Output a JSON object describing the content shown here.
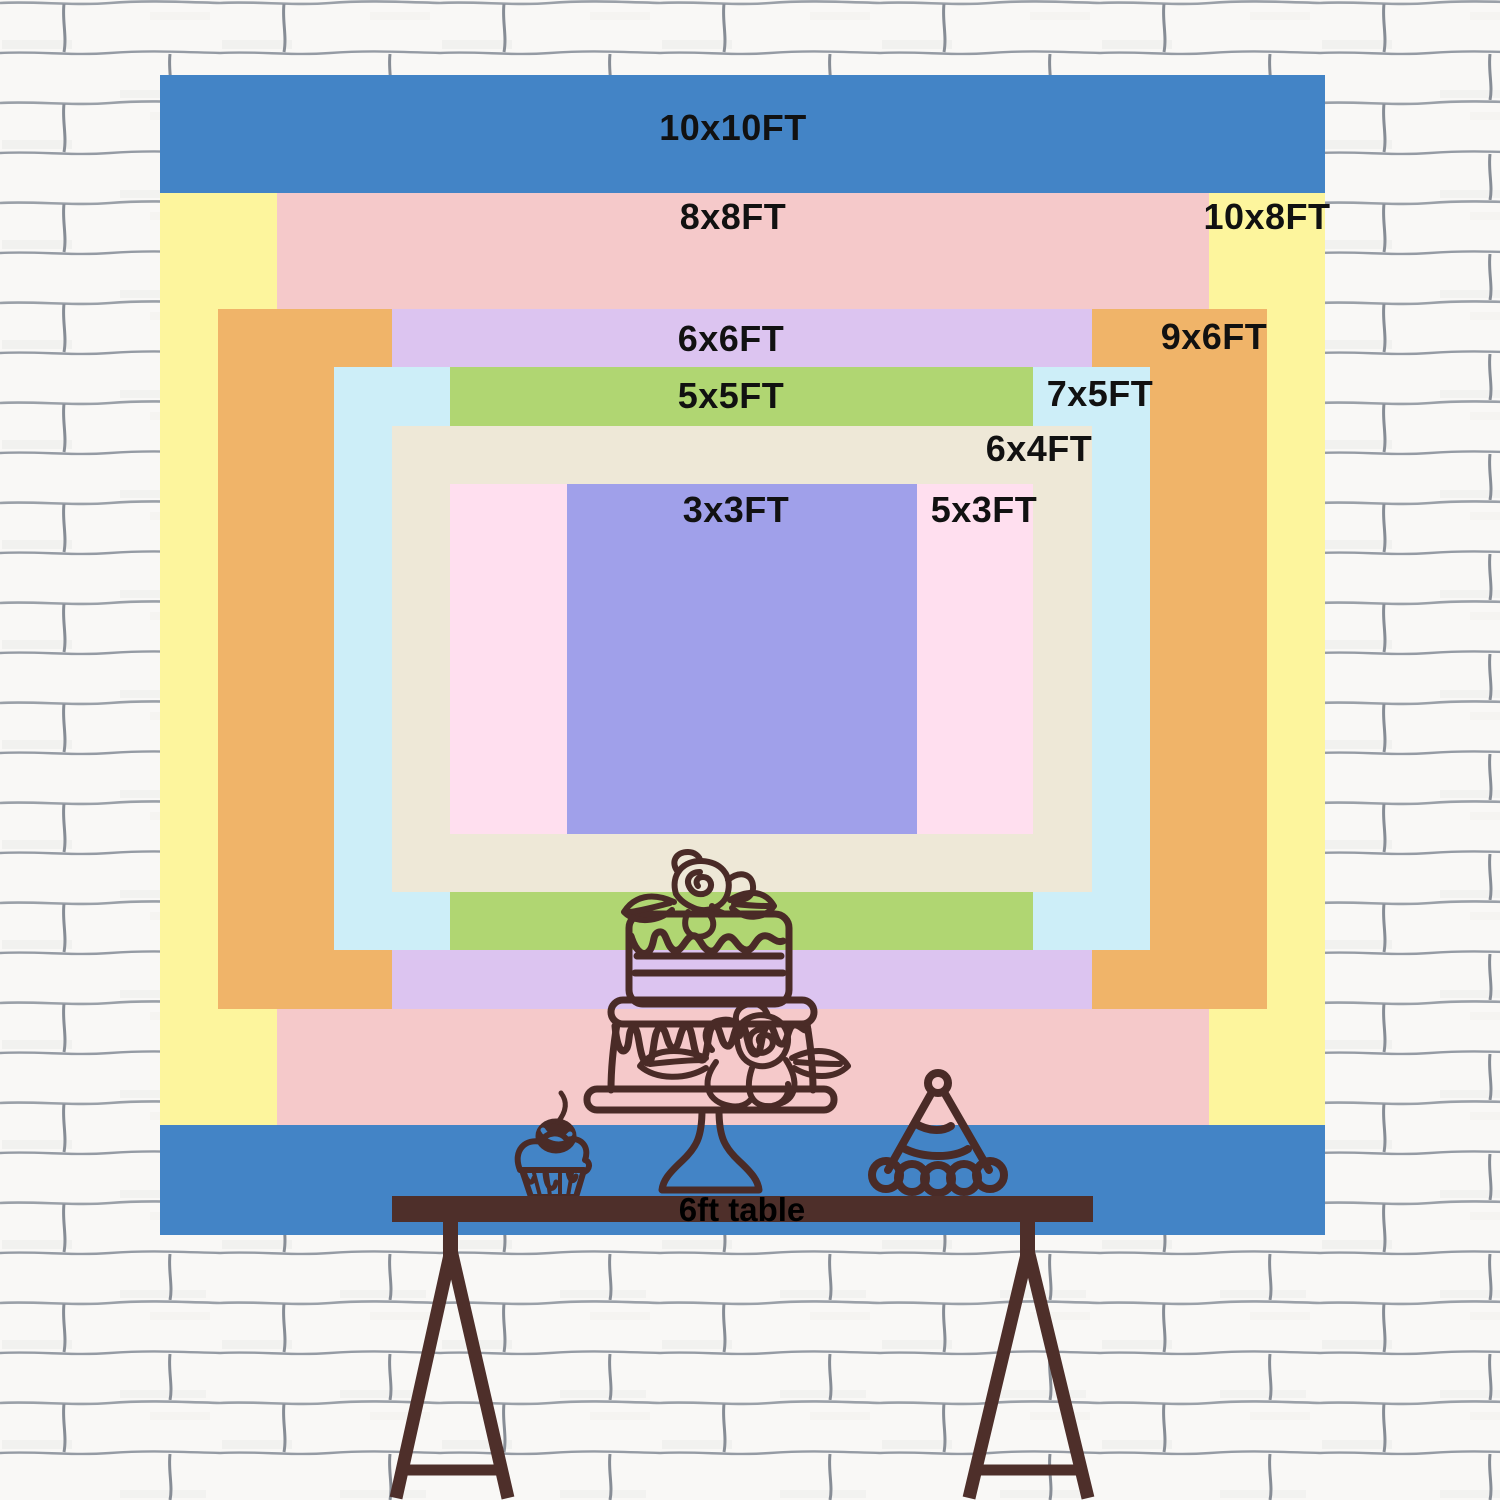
{
  "backdrop": {
    "layers": [
      {
        "size": "10x10FT",
        "width_ft": 10,
        "height_ft": 10,
        "color": "#4384c6"
      },
      {
        "size": "10x8FT",
        "width_ft": 10,
        "height_ft": 8,
        "color": "#fdf59d"
      },
      {
        "size": "8x8FT",
        "width_ft": 8,
        "height_ft": 8,
        "color": "#f5c9ca"
      },
      {
        "size": "9x6FT",
        "width_ft": 9,
        "height_ft": 6,
        "color": "#f0b469"
      },
      {
        "size": "6x6FT",
        "width_ft": 6,
        "height_ft": 6,
        "color": "#dcc4f0"
      },
      {
        "size": "7x5FT",
        "width_ft": 7,
        "height_ft": 5,
        "color": "#cdeef8"
      },
      {
        "size": "5x5FT",
        "width_ft": 5,
        "height_ft": 5,
        "color": "#b0d672"
      },
      {
        "size": "6x4FT",
        "width_ft": 6,
        "height_ft": 4,
        "color": "#eee8d7"
      },
      {
        "size": "5x3FT",
        "width_ft": 5,
        "height_ft": 3,
        "color": "#ffdfef"
      },
      {
        "size": "3x3FT",
        "width_ft": 3,
        "height_ft": 3,
        "color": "#a0a0ea"
      }
    ],
    "label_color": "#111111"
  },
  "table": {
    "label": "6ft table",
    "color": "#4e2f2a"
  },
  "illustration": {
    "outline_color": "#4a2b27",
    "items": [
      "tiered-cake",
      "cupcake-with-cherry",
      "party-hat"
    ]
  },
  "wall": {
    "base_color": "#f9f8f6",
    "mortar_color": "#959ba4"
  }
}
